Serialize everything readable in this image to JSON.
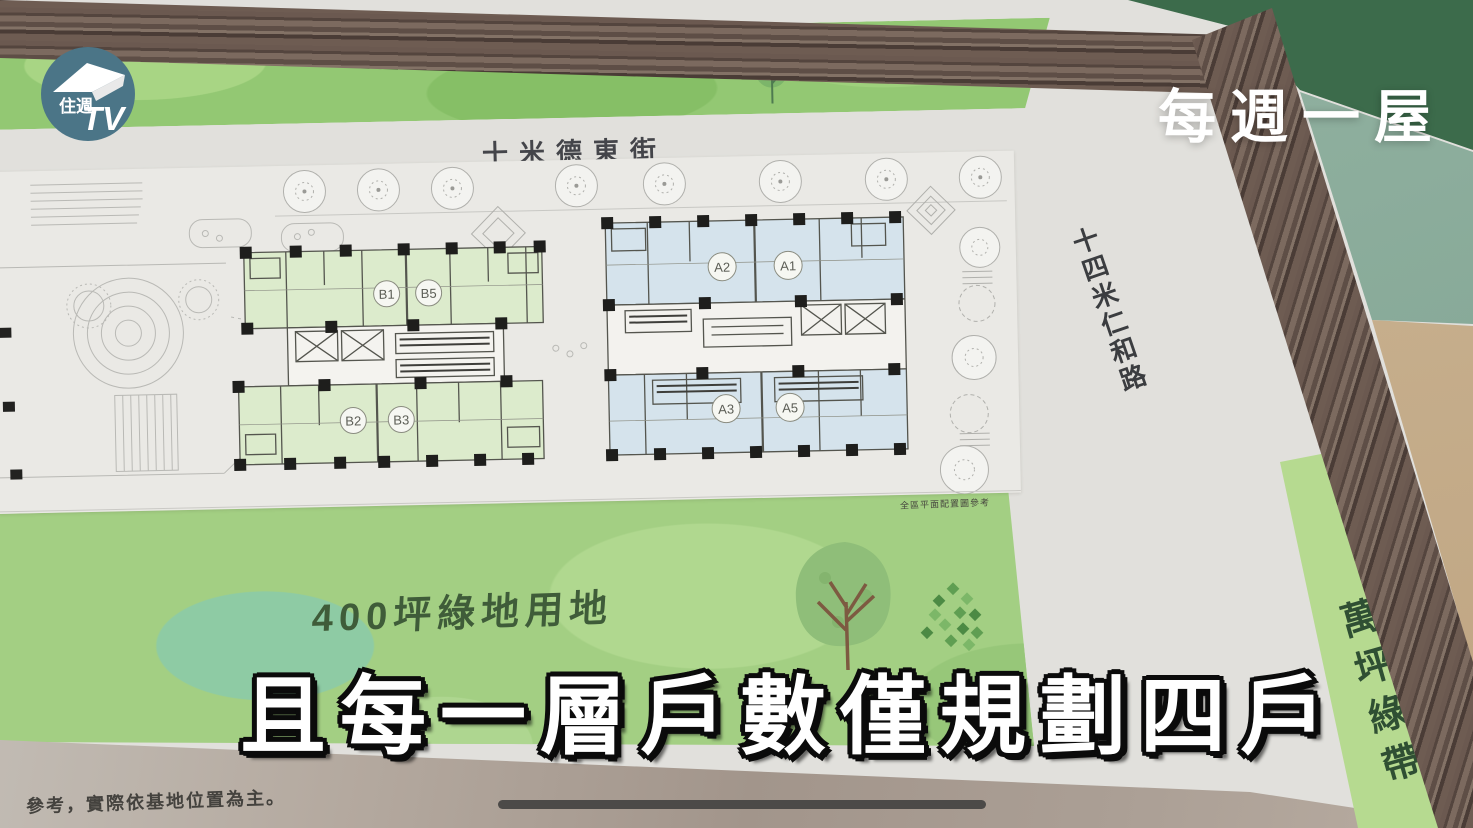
{
  "overlay": {
    "logo": {
      "line1": "住週",
      "tv": "TV"
    },
    "watermark": "每週一屋",
    "subtitle": "且每一層戶數僅規劃四戶",
    "disclaimer": "參考，實際依基地位置為主。"
  },
  "board": {
    "school_label": "德高國小",
    "street_top_label": "十米德東街",
    "road_right_label": "十四米仁和路",
    "green_belt_label": "萬坪綠帶",
    "green_area_label": "400坪綠地用地",
    "plan_note": "全區平面配置圖參考",
    "buildings": {
      "left": {
        "top_units": [
          "B1",
          "B5"
        ],
        "bottom_units": [
          "B2",
          "B3"
        ]
      },
      "right": {
        "top_units": [
          "A2",
          "A1"
        ],
        "bottom_units": [
          "A3",
          "A5"
        ]
      }
    }
  },
  "colors": {
    "board_green": "#9ccb77",
    "plan_gray": "#eae9e5",
    "unit_green": "#dcebcc",
    "unit_blue": "#d5e3ec",
    "wood_frame": "#6b5950",
    "green_belt": "#b6da90",
    "logo_teal": "#4b7587",
    "progress_bar": "#4c4a48"
  }
}
